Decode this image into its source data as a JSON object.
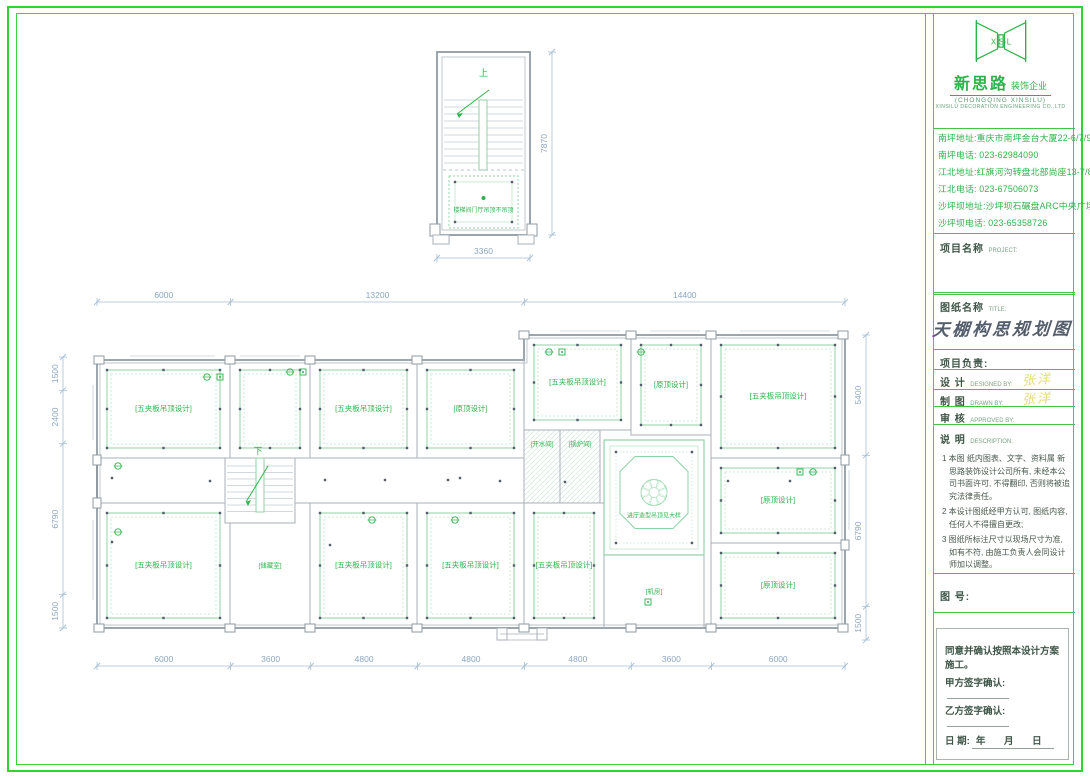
{
  "company": {
    "logo_letters": "X·S·L",
    "name": "新思路",
    "suffix": "装饰企业",
    "sub": "(CHONGQING XINSILU)",
    "sub_en": "XINSILU DECORATION ENGINEERING CO.,LTD",
    "addresses": [
      "南坪地址:重庆市南坪金台大厦22-6/7/9/10",
      "南坪电话: 023-62984090",
      "江北地址:红旗河沟转盘北部尚座13-7/8/9",
      "江北电话: 023-67506073",
      "沙坪坝地址:沙坪坝石碾盘ARC中央广场1/10/3",
      "沙坪坝电话: 023-65358726"
    ]
  },
  "title_block": {
    "project_label": "项目名称",
    "project_en": "PROJECT:",
    "drawing_label": "图纸名称",
    "drawing_en": "TITLE:",
    "drawing_title": "天棚构思规划图",
    "leader_label": "项目负责:",
    "design_label": "设  计",
    "design_en": "DESIGNED BY:",
    "design_value": "张洋",
    "draft_label": "制  图",
    "draft_en": "DRAWN BY:",
    "draft_value": "张洋",
    "approve_label": "审  核",
    "approve_en": "APPROVED BY:",
    "desc_label": "说  明",
    "desc_en": "DESCRIPTION:",
    "notes": [
      "1 本图 纸内图表、文字、资料属 新思路装饰设计公司所有, 未经本公司书面许可, 不得翻印, 否则将被追究法律责任。",
      "2 本设计图纸经甲方认可, 图纸内容, 任何人不得擅自更改;",
      "3 图纸所标注尺寸以现场尺寸为准, 如有不符, 由施工负责人会同设计师加以调整。"
    ],
    "number_label": "图  号:",
    "agreement": {
      "line": "同意并确认按照本设计方案施工。",
      "party_a": "甲方签字确认:",
      "party_b": "乙方签字确认:",
      "date_label": "日        期:",
      "date_suffix": "年  月  日"
    }
  },
  "plan": {
    "colors": {
      "wall": "#a8b2ba",
      "wall_dark": "#8f9aa3",
      "win": "#c6d0d8",
      "coffer": "#8fd3a6",
      "coffer_light": "#bfe6cc",
      "text": "#2db34a",
      "dim": "#a9bfd4",
      "dim_text": "#8ca6c0",
      "dot": "#555f69"
    },
    "top_unit": {
      "x": 437,
      "y": 52,
      "w": 93,
      "h": 183,
      "up": "上",
      "room_label": "楼梯间门厅吊顶不吊顶",
      "dim_bottom": [
        3360
      ],
      "dim_right": [
        7870
      ]
    },
    "main": {
      "x0": 97,
      "x1": 845,
      "y_top_left": 360,
      "y_top_right": 335,
      "step_x": 524,
      "y_mid1": 458,
      "y_mid2": 503,
      "y_bot": 628,
      "cols": [
        230,
        310,
        417,
        524,
        631,
        711
      ],
      "down": "下",
      "labels": {
        "long": "[五夹板吊顶设计]",
        "short": "[原顶设计]",
        "water": "[开水间]",
        "boiler": "[锅炉间]",
        "storage": "[储藏室]",
        "machine": "[机房]",
        "lobby": "进厅造型吊顶见大样"
      },
      "rooms": [
        {
          "x": 97,
          "y": 360,
          "w": 133,
          "h": 98,
          "label": "long"
        },
        {
          "x": 230,
          "y": 360,
          "w": 80,
          "h": 98
        },
        {
          "x": 310,
          "y": 360,
          "w": 107,
          "h": 98,
          "label": "long"
        },
        {
          "x": 417,
          "y": 360,
          "w": 107,
          "h": 98,
          "label": "short"
        },
        {
          "x": 524,
          "y": 335,
          "w": 107,
          "h": 95,
          "label": "long"
        },
        {
          "x": 631,
          "y": 335,
          "w": 80,
          "h": 100,
          "label": "short"
        },
        {
          "x": 711,
          "y": 335,
          "w": 134,
          "h": 123,
          "label": "long"
        },
        {
          "x": 97,
          "y": 503,
          "w": 133,
          "h": 125,
          "label": "long"
        },
        {
          "x": 230,
          "y": 503,
          "w": 80,
          "h": 125,
          "label": "storage"
        },
        {
          "x": 310,
          "y": 503,
          "w": 107,
          "h": 125,
          "label": "long"
        },
        {
          "x": 417,
          "y": 503,
          "w": 107,
          "h": 125,
          "label": "long"
        },
        {
          "x": 524,
          "y": 503,
          "w": 80,
          "h": 125,
          "label": "long"
        },
        {
          "x": 604,
          "y": 555,
          "w": 100,
          "h": 73,
          "label": "machine"
        },
        {
          "x": 711,
          "y": 458,
          "w": 134,
          "h": 85,
          "label": "short"
        },
        {
          "x": 711,
          "y": 543,
          "w": 134,
          "h": 85,
          "label": "short"
        },
        {
          "x": 524,
          "y": 430,
          "w": 36,
          "h": 73,
          "label": "water",
          "hatch": true
        },
        {
          "x": 560,
          "y": 430,
          "w": 40,
          "h": 73,
          "label": "boiler",
          "hatch": true
        }
      ],
      "lobby": {
        "x": 604,
        "y": 440,
        "w": 100,
        "h": 115
      },
      "stair": {
        "x": 225,
        "y": 458,
        "w": 70,
        "h": 65
      },
      "corridor_dots": [
        [
          265,
          480
        ],
        [
          325,
          480
        ],
        [
          385,
          480
        ],
        [
          448,
          480
        ],
        [
          500,
          481
        ],
        [
          565,
          482
        ],
        [
          728,
          481
        ],
        [
          790,
          481
        ],
        [
          112,
          478
        ],
        [
          112,
          542
        ],
        [
          210,
          481
        ],
        [
          330,
          545
        ],
        [
          460,
          478
        ]
      ],
      "fixtures": [
        {
          "x": 207,
          "y": 377,
          "t": "c"
        },
        {
          "x": 220,
          "y": 377,
          "t": "s"
        },
        {
          "x": 290,
          "y": 372,
          "t": "c"
        },
        {
          "x": 303,
          "y": 372,
          "t": "s"
        },
        {
          "x": 549,
          "y": 352,
          "t": "c"
        },
        {
          "x": 562,
          "y": 352,
          "t": "s"
        },
        {
          "x": 800,
          "y": 472,
          "t": "s"
        },
        {
          "x": 813,
          "y": 472,
          "t": "c"
        },
        {
          "x": 648,
          "y": 602,
          "t": "s"
        },
        {
          "x": 118,
          "y": 466,
          "t": "c"
        },
        {
          "x": 118,
          "y": 532,
          "t": "c"
        },
        {
          "x": 372,
          "y": 520,
          "t": "c"
        },
        {
          "x": 455,
          "y": 520,
          "t": "c"
        },
        {
          "x": 641,
          "y": 352,
          "t": "c"
        }
      ],
      "dims": {
        "top": [
          6000,
          13200,
          14400
        ],
        "bottom": [
          6000,
          3600,
          4800,
          4800,
          4800,
          3600,
          6000
        ],
        "left": [
          1500,
          2400,
          6790,
          1500
        ],
        "right": [
          5400,
          6790,
          1500
        ]
      }
    }
  }
}
